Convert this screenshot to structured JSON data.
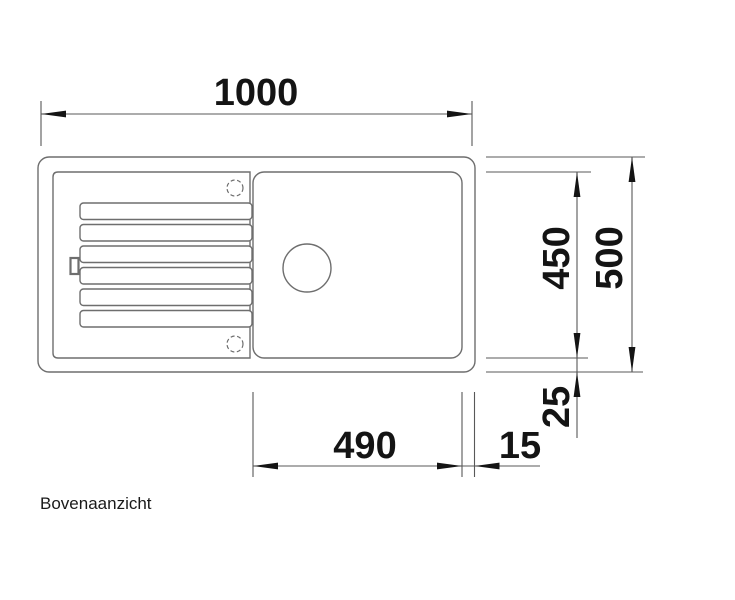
{
  "view_label": "Bovenaanzicht",
  "dimensions": {
    "total_width": "1000",
    "total_depth": "500",
    "inner_depth": "450",
    "bottom_rim": "25",
    "bowl_width": "490",
    "right_rim": "15"
  },
  "colors": {
    "background": "#ffffff",
    "sink_outline": "#6e6e6e",
    "dimension_line": "#585858",
    "text": "#141414"
  }
}
